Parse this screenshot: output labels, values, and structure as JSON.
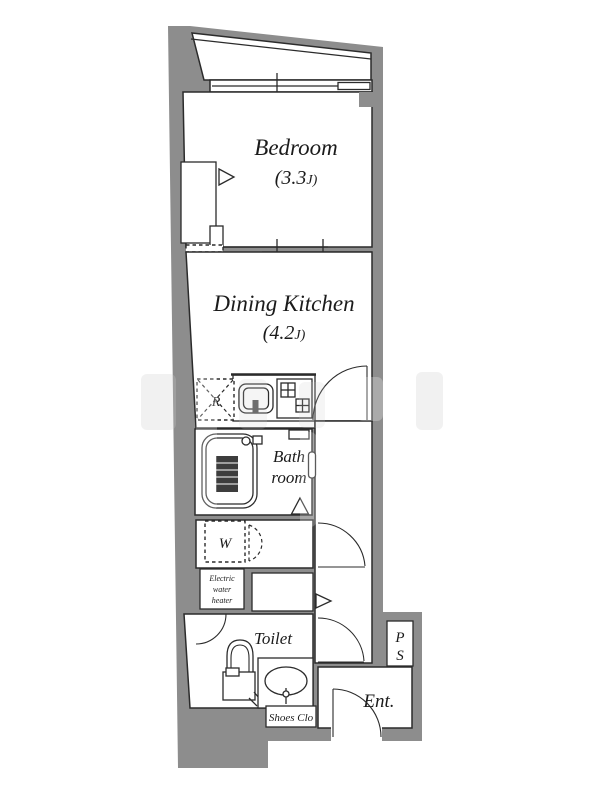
{
  "floorplan": {
    "colors": {
      "wall": "#8d8d8d",
      "line": "#2b2b2b",
      "text": "#1b1b1b"
    },
    "rooms": {
      "bedroom": {
        "name": "Bedroom",
        "size_prefix": "(3.3",
        "size_unit": "J)"
      },
      "dining_kitchen": {
        "name": "Dining Kitchen",
        "size_prefix": "(4.2",
        "size_unit": "J)"
      },
      "bathroom": {
        "line1": "Bath",
        "line2": "room"
      },
      "toilet": {
        "name": "Toilet"
      },
      "entrance": {
        "name": "Ent."
      },
      "pipe_space": {
        "line1": "P",
        "line2": "S"
      },
      "shoes_closet": {
        "name": "Shoes Clo"
      },
      "water_heater": {
        "line1": "Electric",
        "line2": "water",
        "line3": "heater"
      },
      "washer_space": {
        "label": "W"
      },
      "refrigerator_space": {
        "label": "R"
      }
    }
  }
}
